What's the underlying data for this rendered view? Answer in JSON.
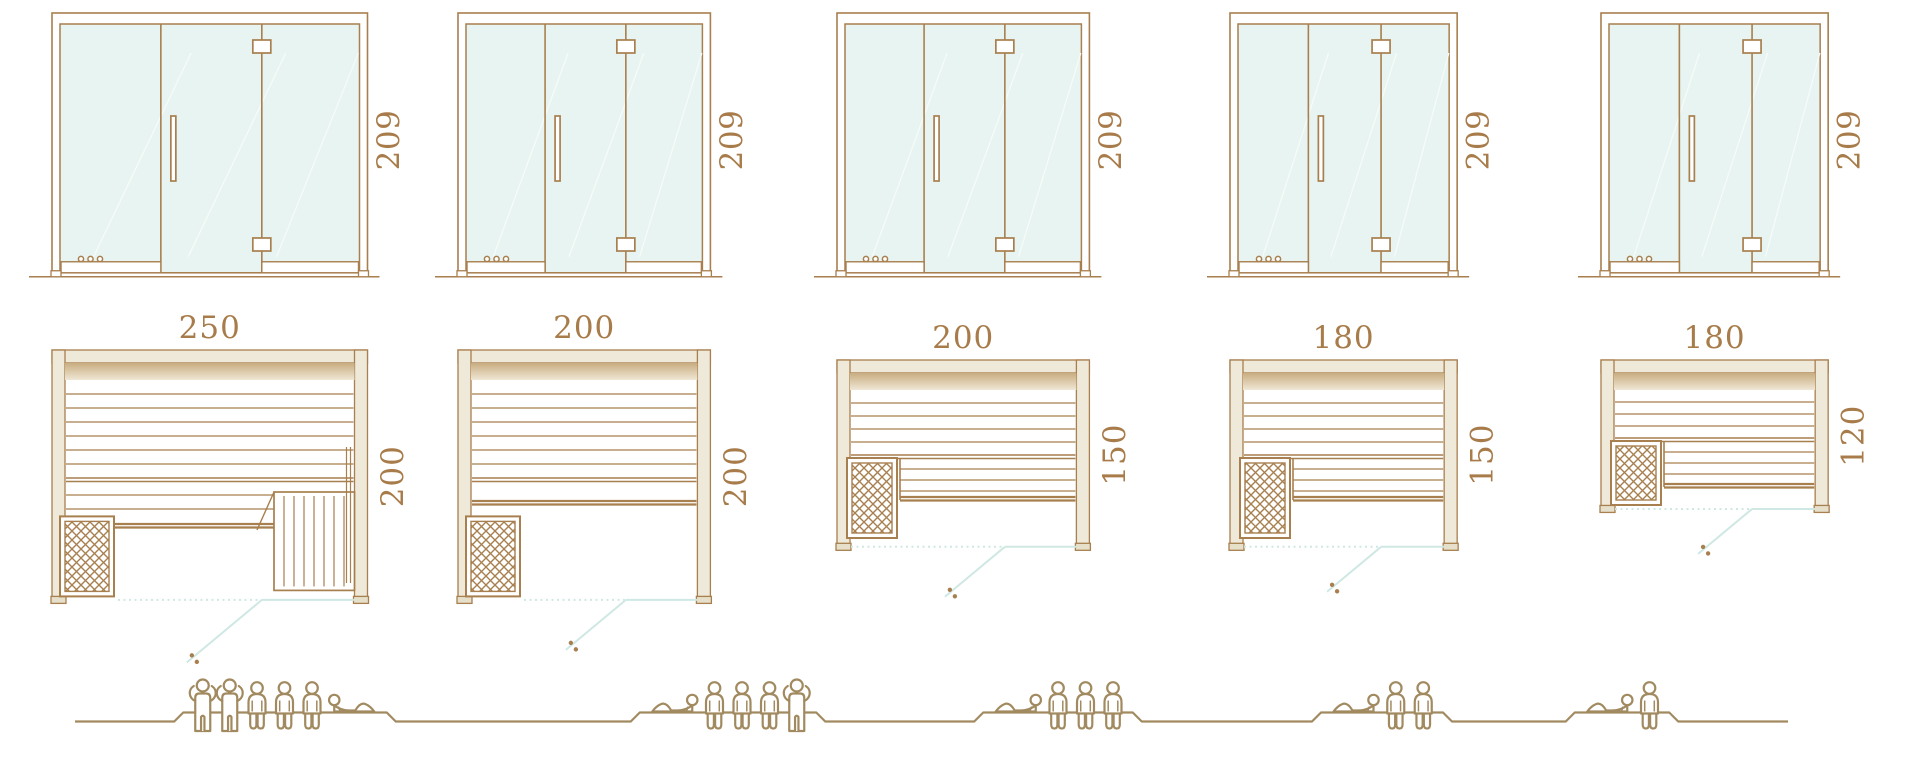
{
  "diagram": {
    "type": "sauna-size-comparison",
    "rows": [
      "front-elevation",
      "floor-plan",
      "capacity-figures"
    ],
    "scale_px_per_cm": 1.262,
    "unit_of_measure": "cm"
  },
  "colors": {
    "outline": "#a87f4e",
    "text": "#a87c4a",
    "wall_fill": "#efe9d9",
    "wall_foot": "#e6dfca",
    "glass_fill": "#e8f4f1",
    "glass_streak": "#f5fbf9",
    "band_dark": "#c9ad81",
    "band_light": "#efe7d4",
    "swing": "#cfe8e4",
    "people": "#a28a60",
    "white": "#ffffff"
  },
  "units": [
    {
      "id": "sauna-250x200",
      "front": {
        "height_label": "209",
        "height_cm": 209
      },
      "plan": {
        "width_label": "250",
        "depth_label": "200",
        "width_cm": 250,
        "depth_cm": 200,
        "heater_position": "front-left",
        "has_lower_bench": true,
        "has_step_bench": true,
        "has_side_bench": false
      },
      "capacity": {
        "total_persons": 6,
        "figures": [
          "standing",
          "standing",
          "sitting",
          "sitting",
          "sitting",
          "lying"
        ],
        "lying_head_side": "left"
      }
    },
    {
      "id": "sauna-200x200",
      "front": {
        "height_label": "209",
        "height_cm": 209
      },
      "plan": {
        "width_label": "200",
        "depth_label": "200",
        "width_cm": 200,
        "depth_cm": 200,
        "heater_position": "front-left",
        "has_lower_bench": true,
        "has_step_bench": false,
        "has_side_bench": false
      },
      "capacity": {
        "total_persons": 5,
        "figures": [
          "lying",
          "sitting",
          "sitting",
          "sitting",
          "standing"
        ],
        "lying_head_side": "right"
      }
    },
    {
      "id": "sauna-200x150",
      "front": {
        "height_label": "209",
        "height_cm": 209
      },
      "plan": {
        "width_label": "200",
        "depth_label": "150",
        "width_cm": 200,
        "depth_cm": 150,
        "heater_position": "mid-left",
        "has_lower_bench": false,
        "has_step_bench": false,
        "has_side_bench": true
      },
      "capacity": {
        "total_persons": 4,
        "figures": [
          "lying",
          "sitting",
          "sitting",
          "sitting"
        ],
        "lying_head_side": "right"
      }
    },
    {
      "id": "sauna-180x150",
      "front": {
        "height_label": "209",
        "height_cm": 209
      },
      "plan": {
        "width_label": "180",
        "depth_label": "150",
        "width_cm": 180,
        "depth_cm": 150,
        "heater_position": "mid-left",
        "has_lower_bench": false,
        "has_step_bench": false,
        "has_side_bench": true
      },
      "capacity": {
        "total_persons": 3,
        "figures": [
          "lying",
          "sitting",
          "sitting"
        ],
        "lying_head_side": "right"
      }
    },
    {
      "id": "sauna-180x120",
      "front": {
        "height_label": "209",
        "height_cm": 209
      },
      "plan": {
        "width_label": "180",
        "depth_label": "120",
        "width_cm": 180,
        "depth_cm": 120,
        "heater_position": "mid-left",
        "has_lower_bench": false,
        "has_step_bench": false,
        "has_side_bench": true
      },
      "capacity": {
        "total_persons": 2,
        "figures": [
          "lying",
          "sitting"
        ],
        "lying_head_side": "right"
      }
    }
  ]
}
